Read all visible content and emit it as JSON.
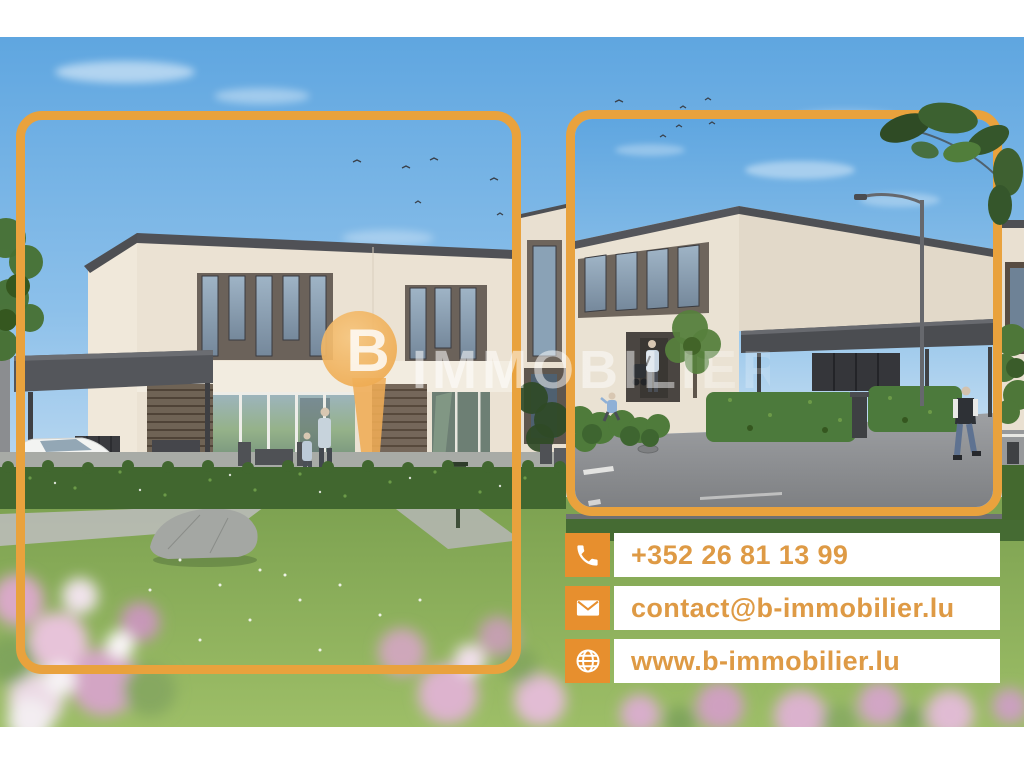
{
  "brand": {
    "logo_letter": "B",
    "logo_text": "IMMOBILIER"
  },
  "contact": {
    "rows": [
      {
        "icon": "phone-icon",
        "text": "+352 26 81 13 99"
      },
      {
        "icon": "envelope-icon",
        "text": "contact@b-immobilier.lu"
      },
      {
        "icon": "globe-icon",
        "text": "www.b-immobilier.lu"
      }
    ]
  },
  "colors": {
    "accent_orange": "#E9A23D",
    "contact_icon_orange": "#E78F2E",
    "contact_text_orange": "#DE9A45",
    "sky_blue": "#5FA6E0"
  }
}
